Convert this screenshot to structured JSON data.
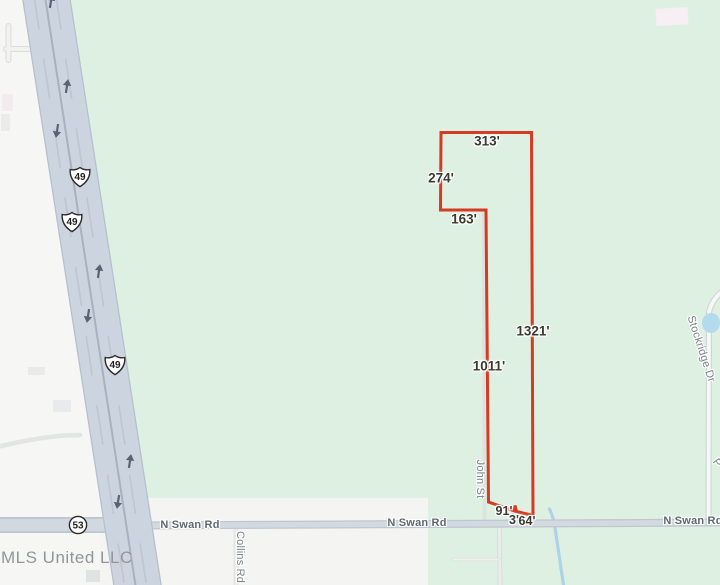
{
  "map": {
    "watermark": "MLS United LLC",
    "shields": {
      "us49": "49",
      "ms53": "53"
    },
    "streets": {
      "n_swan_rd_west": "N Swan Rd",
      "n_swan_rd_center": "N Swan Rd",
      "n_swan_rd_east": "N Swan Rd",
      "collins_rd": "Collins Rd",
      "john_st": "John St",
      "stockridge_dr": "Stockridge Dr",
      "partial_street_label": "P"
    },
    "parcel": {
      "outline_color": "#d73a23",
      "dimensions": [
        {
          "side": "top",
          "text": "313'"
        },
        {
          "side": "upper-left",
          "text": "274'"
        },
        {
          "side": "jog",
          "text": "163'"
        },
        {
          "side": "east",
          "text": "1321'"
        },
        {
          "side": "west",
          "text": "1011'"
        },
        {
          "side": "bottom-west",
          "text": "91'"
        },
        {
          "side": "bottom-jog",
          "text": "3'"
        },
        {
          "side": "bottom-east",
          "text": "64'"
        }
      ]
    },
    "colors": {
      "land_green": "#def0e1",
      "land_gray": "#f6f6f4",
      "highway_fill": "#ccd4df",
      "minor_road": "#d3d9e0",
      "water_blue": "#aed3e7",
      "parcel_red": "#d73a23"
    }
  }
}
